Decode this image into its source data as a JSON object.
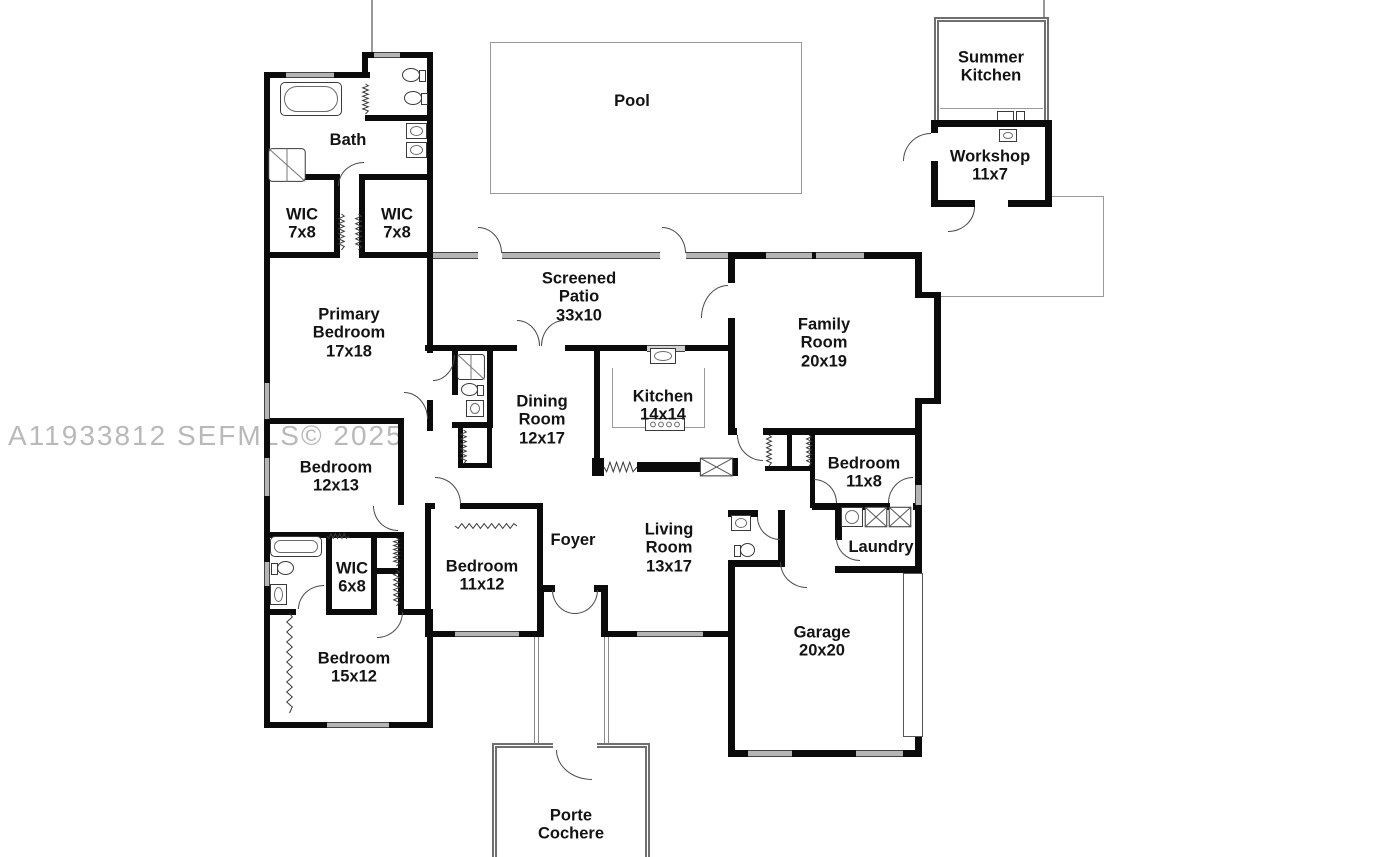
{
  "watermark": "A11933812  SEFMLS© 2025",
  "colors": {
    "wall": "#0b0b0b",
    "window_fill": "#b5b5b5",
    "thin_line": "#999999",
    "watermark_text": "#b9b9b9",
    "label_text": "#131313",
    "background": "#ffffff"
  },
  "rooms": {
    "pool": {
      "name": "Pool"
    },
    "summer_kitchen": {
      "name": "Summer\nKitchen"
    },
    "workshop": {
      "name": "Workshop",
      "dims": "11x7"
    },
    "bath": {
      "name": "Bath"
    },
    "wic_top_left": {
      "name": "WIC",
      "dims": "7x8"
    },
    "wic_top_right": {
      "name": "WIC",
      "dims": "7x8"
    },
    "primary_bedroom": {
      "name": "Primary\nBedroom",
      "dims": "17x18"
    },
    "screened_patio": {
      "name": "Screened\nPatio",
      "dims": "33x10"
    },
    "family_room": {
      "name": "Family\nRoom",
      "dims": "20x19"
    },
    "dining_room": {
      "name": "Dining\nRoom",
      "dims": "12x17"
    },
    "kitchen": {
      "name": "Kitchen",
      "dims": "14x14"
    },
    "bedroom_mid_left": {
      "name": "Bedroom",
      "dims": "12x13"
    },
    "bedroom_right": {
      "name": "Bedroom",
      "dims": "11x8"
    },
    "laundry": {
      "name": "Laundry"
    },
    "foyer": {
      "name": "Foyer"
    },
    "living_room": {
      "name": "Living\nRoom",
      "dims": "13x17"
    },
    "garage": {
      "name": "Garage",
      "dims": "20x20"
    },
    "wic_small": {
      "name": "WIC",
      "dims": "6x8"
    },
    "bedroom_front": {
      "name": "Bedroom",
      "dims": "11x12"
    },
    "bedroom_back": {
      "name": "Bedroom",
      "dims": "15x12"
    },
    "porte_cochere": {
      "name": "Porte\nCochere"
    }
  }
}
